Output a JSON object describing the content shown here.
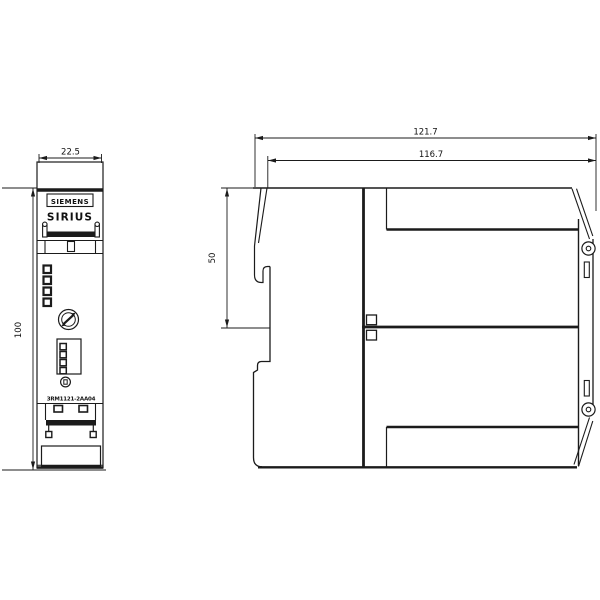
{
  "drawing": {
    "front_view": {
      "brand": "SIEMENS",
      "series": "SIRIUS",
      "part_number": "3RM1121-2AA04",
      "width_dim": "22.5",
      "height_dim": "100"
    },
    "side_view": {
      "depth_total_dim": "121.7",
      "depth_body_dim": "116.7",
      "upper_height_dim": "50"
    },
    "colors": {
      "line": "#1b1b1b",
      "background": "#ffffff"
    }
  }
}
